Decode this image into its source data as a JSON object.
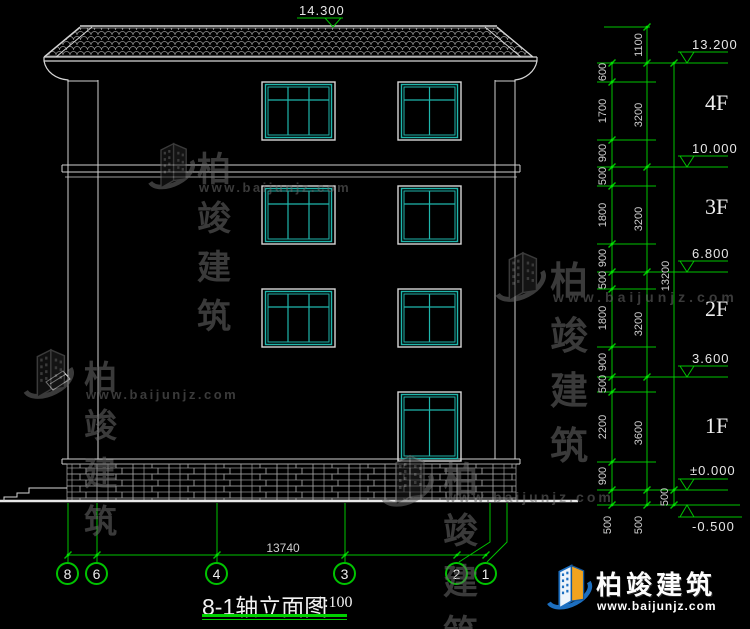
{
  "drawing_title": {
    "name": "8-1轴立面图",
    "scale": "1:100"
  },
  "ridge_elevation": "14.300",
  "floor_labels": [
    "4F",
    "3F",
    "2F",
    "1F"
  ],
  "elevation_marks": [
    "13.200",
    "10.000",
    "6.800",
    "3.600",
    "±0.000",
    "-0.500"
  ],
  "dims": {
    "inner": [
      "600",
      "1700",
      "900",
      "500",
      "1800",
      "900",
      "500",
      "1800",
      "900",
      "500",
      "2200",
      "900",
      "500"
    ],
    "story": [
      "1100",
      "3200",
      "3200",
      "3200",
      "3600",
      "500"
    ],
    "total": [
      "13200",
      "500"
    ],
    "bottom_total": "13740"
  },
  "axes": [
    "8",
    "6",
    "4",
    "3",
    "2",
    "1"
  ],
  "watermark": {
    "brand": "柏竣建筑",
    "url": "www.baijunjz.com"
  },
  "footer_brand": {
    "brand": "柏竣建筑",
    "url": "www.baijunjz.com"
  },
  "colors": {
    "dimension_green": "#00c400",
    "line_white": "#d6d6d6",
    "window_teal": "#1fb6ac",
    "brand_blue": "#1d6fc0",
    "brand_orange": "#f2a31d"
  }
}
